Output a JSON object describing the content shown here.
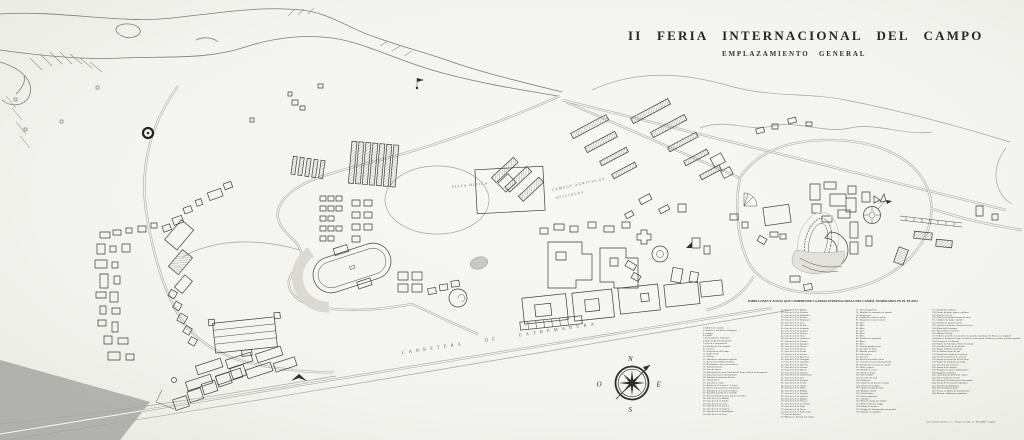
{
  "map": {
    "title": "II FERIA INTERNACIONAL DEL CAMPO",
    "subtitle": "EMPLAZAMIENTO GENERAL",
    "road_label": "CARRETERA DE EXTREMADURA",
    "labels": {
      "pista": "PISTA HIPICA",
      "campos_line1": "CAMPOS AGRICOLAS",
      "campos_line2": "OFICIALES"
    }
  },
  "compass": {
    "n": "N",
    "e": "E",
    "s": "S",
    "o": "O"
  },
  "legend": {
    "header": "PABELLONES Y ZONAS QUE COMPRENDE LA FERIA INTERNACIONAL DEL CAMPO, NUMERADOS EN EL PLANO",
    "col1": [
      "1.-Edificio de entrada",
      "2.-Oficinas y Teléfonos y Telégrafos",
      "3.-Aduana",
      "4.-Capilla",
      "5.-Hermandad de Labradores",
      "6.-Obra Sindical Colonización",
      "7.-Caja de Compensación",
      "8.-Pabellón del Vino Español",
      "9.-Artesanía",
      "10.-Cooperación del Campo",
      "11.-Teatro Verde",
      "12.-Cinema",
      "13.-Pabellón de maquinaria agrícola",
      "14.-Escuela de Industrias Lácteas",
      "15.-Restaurantes, bares y merenderos",
      "16.-Establecimientos",
      "17.-Casa de Aperos",
      "18.-Pabellón del Servicio Nacional del Trigo y Silo de Demostración",
      "19.-Junta Nacional de Hermandades",
      "20.-Pabellón de Industrias Rurales",
      "21.-Alojamientos",
      "22.-Estación de enlace",
      "23.-Estufas de la Sección 1.ª y Pozos",
      "24.-Huerta arquitectónica y Laboratorio",
      "25.-Pabellón de la Sección de Olivos",
      "26.-Estación de la Huerta y el Prado",
      "27.-Escuela Oficial Central: Agentes del Olivo",
      "28.-Casa de la P. de Madrid",
      "29.-Casa de la P. de Toledo",
      "30.-Casa de la P. de Ávila",
      "31.-Casa de la P. de Cuenca",
      "32.-Casa de la P. de Segovia",
      "33.-Casa de la P. de Guadalajara",
      "34.-Casa de la P. de Soria"
    ],
    "col2": [
      "35.-Casa de la P. de Burgos",
      "36.-Casa de la P. de Palencia",
      "37.-Casa de la P. de Valladolid",
      "38.-Casa de la P. de Zamora",
      "39.-Casa de la P. de Salamanca",
      "40.-Casa de la P. de León",
      "41.-Casa de la P. de Oviedo",
      "42.-Casa de la P. de Santander",
      "43.-Casa de la P. de Logroño",
      "44.-Casa de la P. de Navarra",
      "45.-Casa de la P. de Álava",
      "46.-Casa de la P. de Guipúzcoa",
      "47.-Casa de la P. de Vizcaya",
      "48.-Casa de la P. de Zaragoza",
      "49.-Casa de la P. de Huesca",
      "50.-Casa de la P. de Teruel",
      "51.-Casa de la P. de Lérida",
      "52.-Casa de la P. de Gerona",
      "53.-Casa de la P. de Barcelona",
      "54.-Casa de la P. de Tarragona",
      "55.-Casa de la P. de Castellón",
      "56.-Casa de la P. de Valencia",
      "57.-Casa de la P. de Alicante",
      "58.-Casa de la P. de Murcia",
      "59.-Casa de la P. de Albacete",
      "60.-Casa de la P. de Ciudad Real",
      "61.-Casa de la P. de Jaén",
      "62.-Casa de la P. de Córdoba",
      "63.-Casa de la P. de Sevilla",
      "64.-Casa de la P. de Huelva",
      "65.-Casa de la P. de Cádiz",
      "66.-Casa de la P. de Málaga",
      "67.-Casa de la P. de Granada",
      "68.-Casa de la P. de Almería",
      "69.-Casa de la P. de Badajoz",
      "70.-Casa de la P. de Cáceres",
      "71.-Casa de la P. de La Coruña",
      "72.-Casa de la P. de Lugo",
      "73.-Casa de la P. de Orense",
      "74.-Casa de la P. de Pontevedra",
      "75.-Casa de Baleares",
      "76.-Marruecos. Plaza de los Caídos"
    ],
    "col3": [
      "77.-Casa del ganadero",
      "78.-Depósito de sementales de ganado",
      "79.-Porquerizas",
      "80.-Cuadras de vacas de ordeño",
      "81.-Vaquerías de razas lecheras",
      "82.-Silos",
      "83.-Ídem",
      "84.-Ídem",
      "85.-Ídem",
      "86.-Ídem",
      "87.-Ídem",
      "88.-Establos de exposición",
      "89.-Ídem",
      "90.-Ídem",
      "91.-Pista de ganado menor",
      "92.-Lavadero de lanas",
      "93.-Báscula y muelles",
      "94.-Abrevaderos",
      "95.-Lazareto",
      "96.-Escuela Nacional Lechera",
      "97.-Central Lechera de Demostración",
      "98.-Establos del Concurso de ordeño",
      "99.-Henil y pajares",
      "100.-Molino de viento",
      "101.-Noria de sangre",
      "102.-Era de trillar",
      "103.-Secadero de maíz",
      "104.-Palomares",
      "105.-Gallineros de puesta y conejar",
      "106.-Colmenar movilista",
      "107.-Aprisco de ganado lanar",
      "108.-Majada y tinada",
      "109.-Cabaña típica",
      "110.-Chozos pastoriles",
      "111.-Almiares",
      "112.-Plaza de tientas y herradero",
      "113.-Potro de herrar y fragua",
      "114.-Garaje de tractores",
      "115.-Campos de demostración con parador",
      "116.-Frutales en espaldera"
    ],
    "col4": [
      "117.-Granja de avicultura",
      "118.-Parque de patos, gansos y gallinas",
      "119.-Club de la Feria",
      "120.-Corrales de ganado vacuno de carne",
      "121.-Caballos de sangre española",
      "122.-Cuadras de ganado selecto",
      "123.-Galerías con trofeos. Recinto de ferias",
      "124.-Music-hall del parque",
      "125.-Plaza Mayor de la Feria",
      "126.-Mirador del lago",
      "127.-Edificio social de la Asociación General de Ganaderos del Reino, con campo de exhibiciones, Restaurante típico, Centro de información, Reuniones sociales y bailes regionales",
      "128.-Terrazas de la Alameda",
      "129.-Ermita de San Isidro, Patrón del campo",
      "130.-Casa del Frente de Juventudes",
      "131.-Parque infantil y Guardería",
      "132.-La Tahona: horno de pan",
      "133.-Estación de autobuses. Cocheras",
      "134.-Central telefónica y de Correos",
      "135.-Puesto de socorro de la Cruz Roja",
      "136.-Parque de bomberos forestales",
      "137.-Casa forestal y Viveros",
      "138.-Fuente de los Pájaros",
      "139.-Estanque de barcas. Embarcadero",
      "140.-Pérgolas y rosaledas",
      "141.-Aparcamiento general de coches",
      "142.-Silo elevador de cereales",
      "143.-Puerta de la Carretera de Extremadura",
      "144.-Puerta del Ferrocarril Suburbano",
      "145.-Estación del Suburbano",
      "146.-Casa del guarda mayor",
      "147.-Cercas y vallados de demostración",
      "148.-Plaza de exhibiciones ganaderas"
    ]
  },
  "imprint": "Artes Gráficas MAG, S. A. - Duque de Alba, 13 - MADRID - España"
}
